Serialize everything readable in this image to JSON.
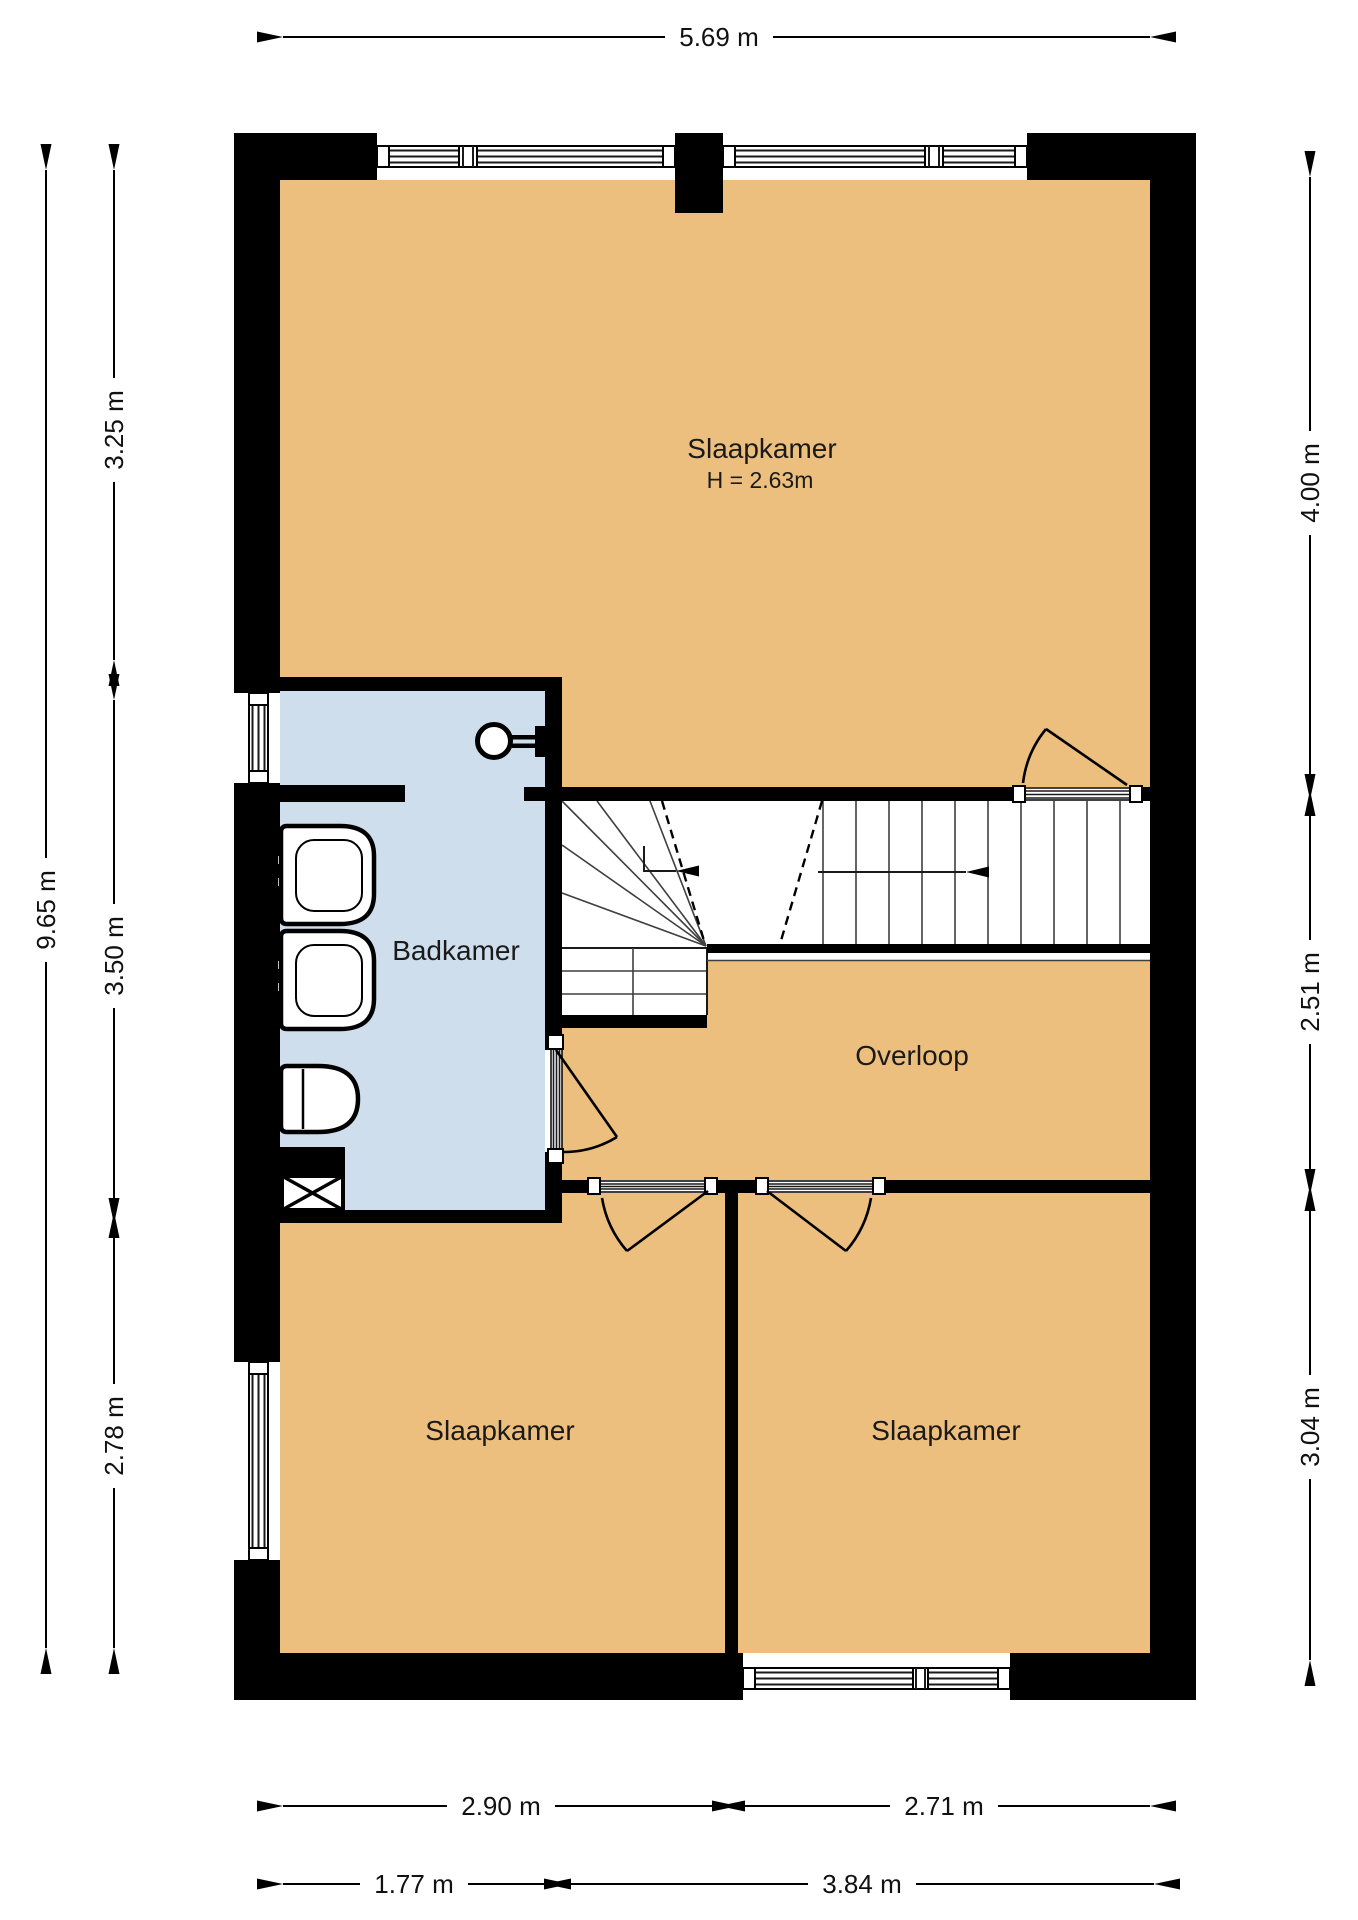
{
  "plan": {
    "rooms": [
      {
        "id": "bedroom-top",
        "label": "Slaapkamer",
        "note": "H = 2.63m"
      },
      {
        "id": "bathroom",
        "label": "Badkamer"
      },
      {
        "id": "landing",
        "label": "Overloop"
      },
      {
        "id": "bedroom-bottom-left",
        "label": "Slaapkamer"
      },
      {
        "id": "bedroom-bottom-right",
        "label": "Slaapkamer"
      }
    ],
    "dimensions": {
      "top_width": "5.69 m",
      "left_total": "9.65 m",
      "left_top": "3.25 m",
      "left_middle": "3.50 m",
      "left_bottom": "2.78 m",
      "right_top": "4.00 m",
      "right_middle": "2.51 m",
      "right_bottom": "3.04 m",
      "bottom_room_left": "2.90 m",
      "bottom_room_right": "2.71 m",
      "bottom_bathroom": "1.77 m",
      "bottom_landing": "3.84 m"
    },
    "colors": {
      "floor": "#EDBF7E",
      "bathroom_floor": "#CFDEEC",
      "wall": "#000000",
      "background": "#FFFFFF"
    }
  }
}
